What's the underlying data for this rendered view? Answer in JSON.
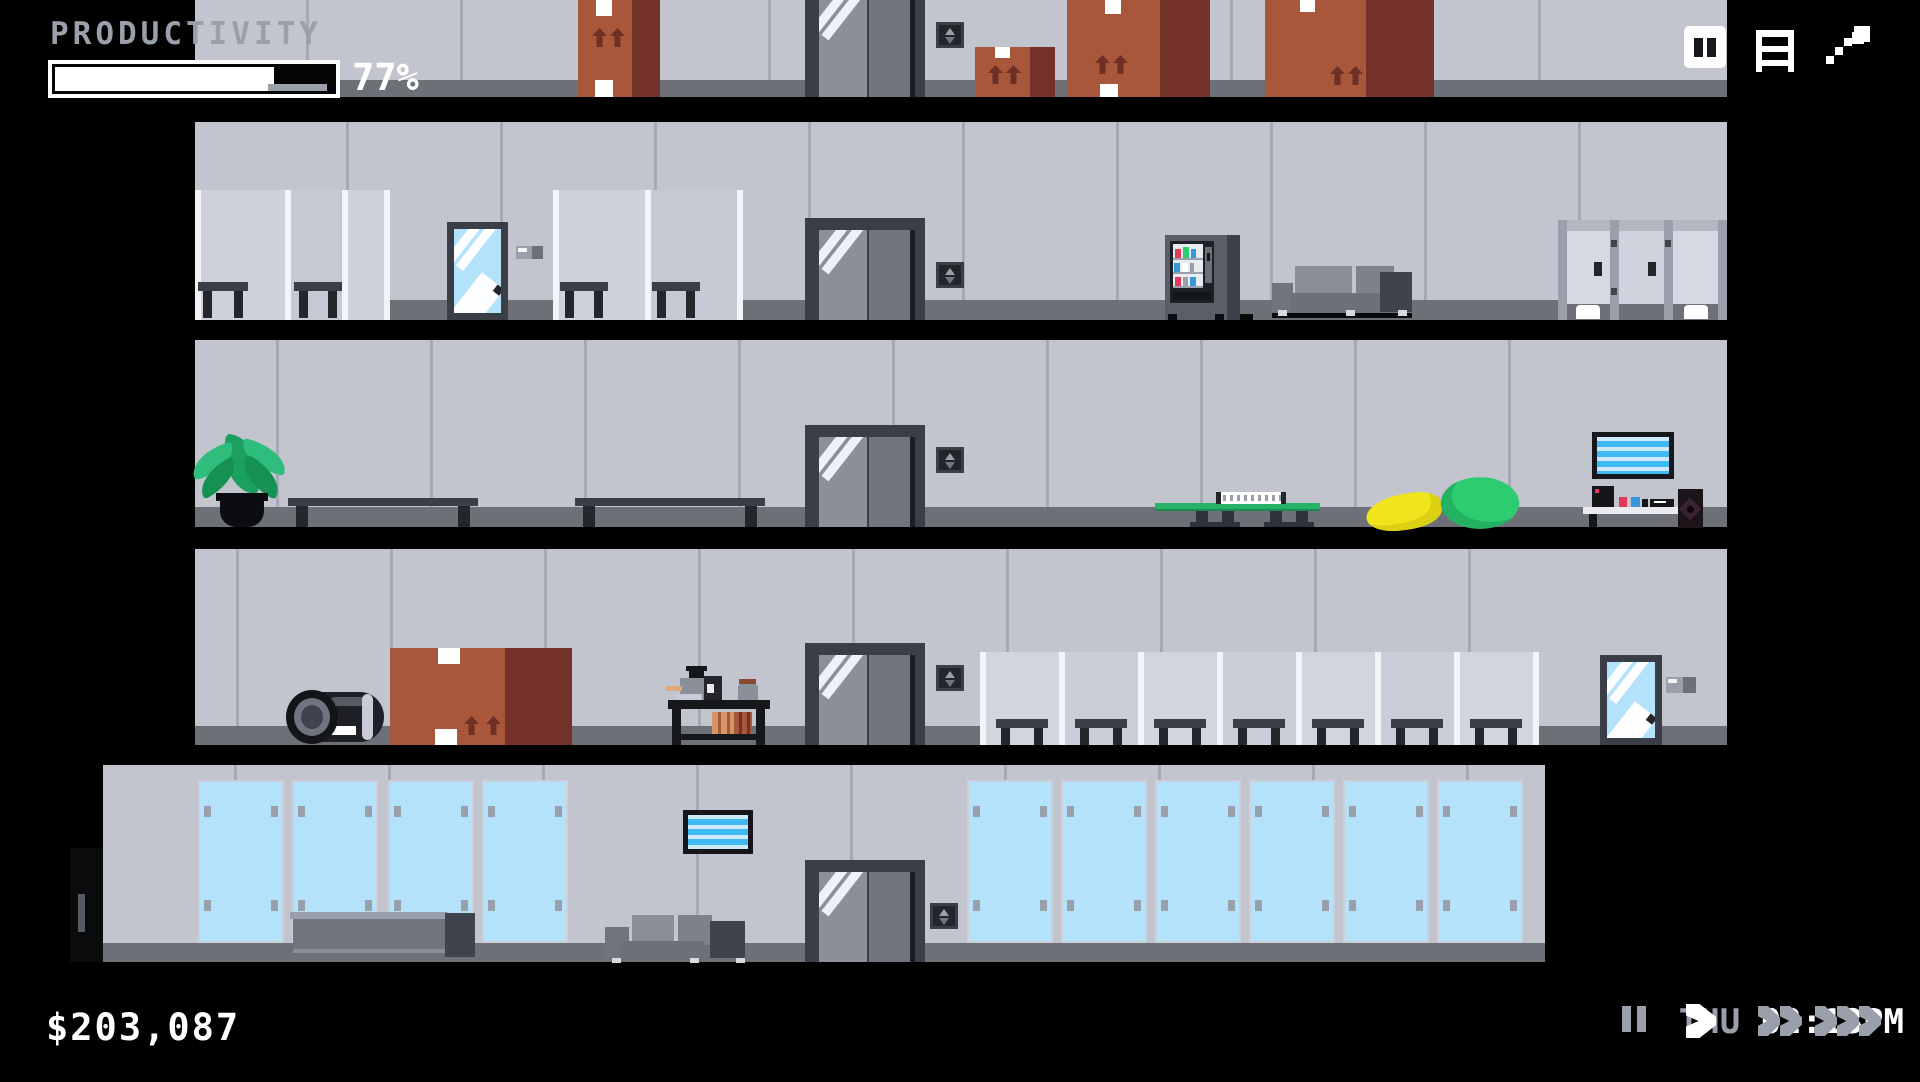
{
  "hud": {
    "productivity": {
      "label": "PRODUCTIVITY",
      "percent": 77,
      "percent_label": "77%"
    },
    "money": "$203,087",
    "clock": {
      "day": "THU",
      "time": "02:13PM"
    },
    "window_buttons": [
      {
        "name": "pause-window-button",
        "icon": "pause-icon",
        "style": "white-square"
      },
      {
        "name": "roster-button",
        "icon": "list-icon"
      },
      {
        "name": "stats-button",
        "icon": "trend-arrow-icon"
      }
    ],
    "speed_controls": [
      {
        "name": "pause",
        "icon": "pause-icon",
        "active": false
      },
      {
        "name": "play",
        "icon": "play-icon",
        "active": true
      },
      {
        "name": "fast-forward",
        "icon": "double-chevron-icon",
        "active": false
      },
      {
        "name": "max-speed",
        "icon": "triple-chevron-icon",
        "active": false
      }
    ]
  },
  "colors": {
    "background": "#000000",
    "wall": "#c2c4ce",
    "wall_seam": "#a6a9b3",
    "baseboard": "#6e7077",
    "elevator_frame": "#3a3e47",
    "glass_blue": "#b5e2fb",
    "cardboard": "#a8573b",
    "cardboard_shade": "#743127",
    "hud_gray": "#9aa0ab",
    "hud_white": "#ffffff",
    "tv_stripe": "#3fbaf2",
    "plant_green": "#2ebd7c",
    "bean_yellow": "#f0e51d",
    "bean_green": "#2ecc71",
    "vending_red": "#e23a57",
    "vending_blue": "#3498db"
  },
  "building": {
    "floors": [
      {
        "name": "storage-floor",
        "objects": [
          "cardboard-box",
          "elevator",
          "elevator-call-panel",
          "cardboard-box",
          "cardboard-box",
          "cardboard-box"
        ]
      },
      {
        "name": "office-floor-upper",
        "objects": [
          "cubicle-desks",
          "glass-door",
          "door-sign",
          "cubicle-desks",
          "elevator",
          "elevator-call-panel",
          "vending-machine",
          "sofa",
          "toilet-stalls"
        ]
      },
      {
        "name": "lounge-floor",
        "objects": [
          "potted-plant",
          "bench",
          "bench",
          "elevator",
          "elevator-call-panel",
          "ping-pong-table",
          "bean-bag-yellow",
          "bean-bag-green",
          "wall-tv",
          "media-console"
        ]
      },
      {
        "name": "office-floor-lower",
        "objects": [
          "tipped-barrel",
          "cardboard-box",
          "coffee-cart",
          "elevator",
          "elevator-call-panel",
          "cubicle-row",
          "glass-door",
          "door-sign"
        ]
      },
      {
        "name": "lobby",
        "objects": [
          "entrance-door",
          "glass-wall-panels",
          "reception-desk",
          "wall-tv",
          "sofa",
          "elevator",
          "elevator-call-panel",
          "glass-wall-panels"
        ]
      }
    ]
  }
}
